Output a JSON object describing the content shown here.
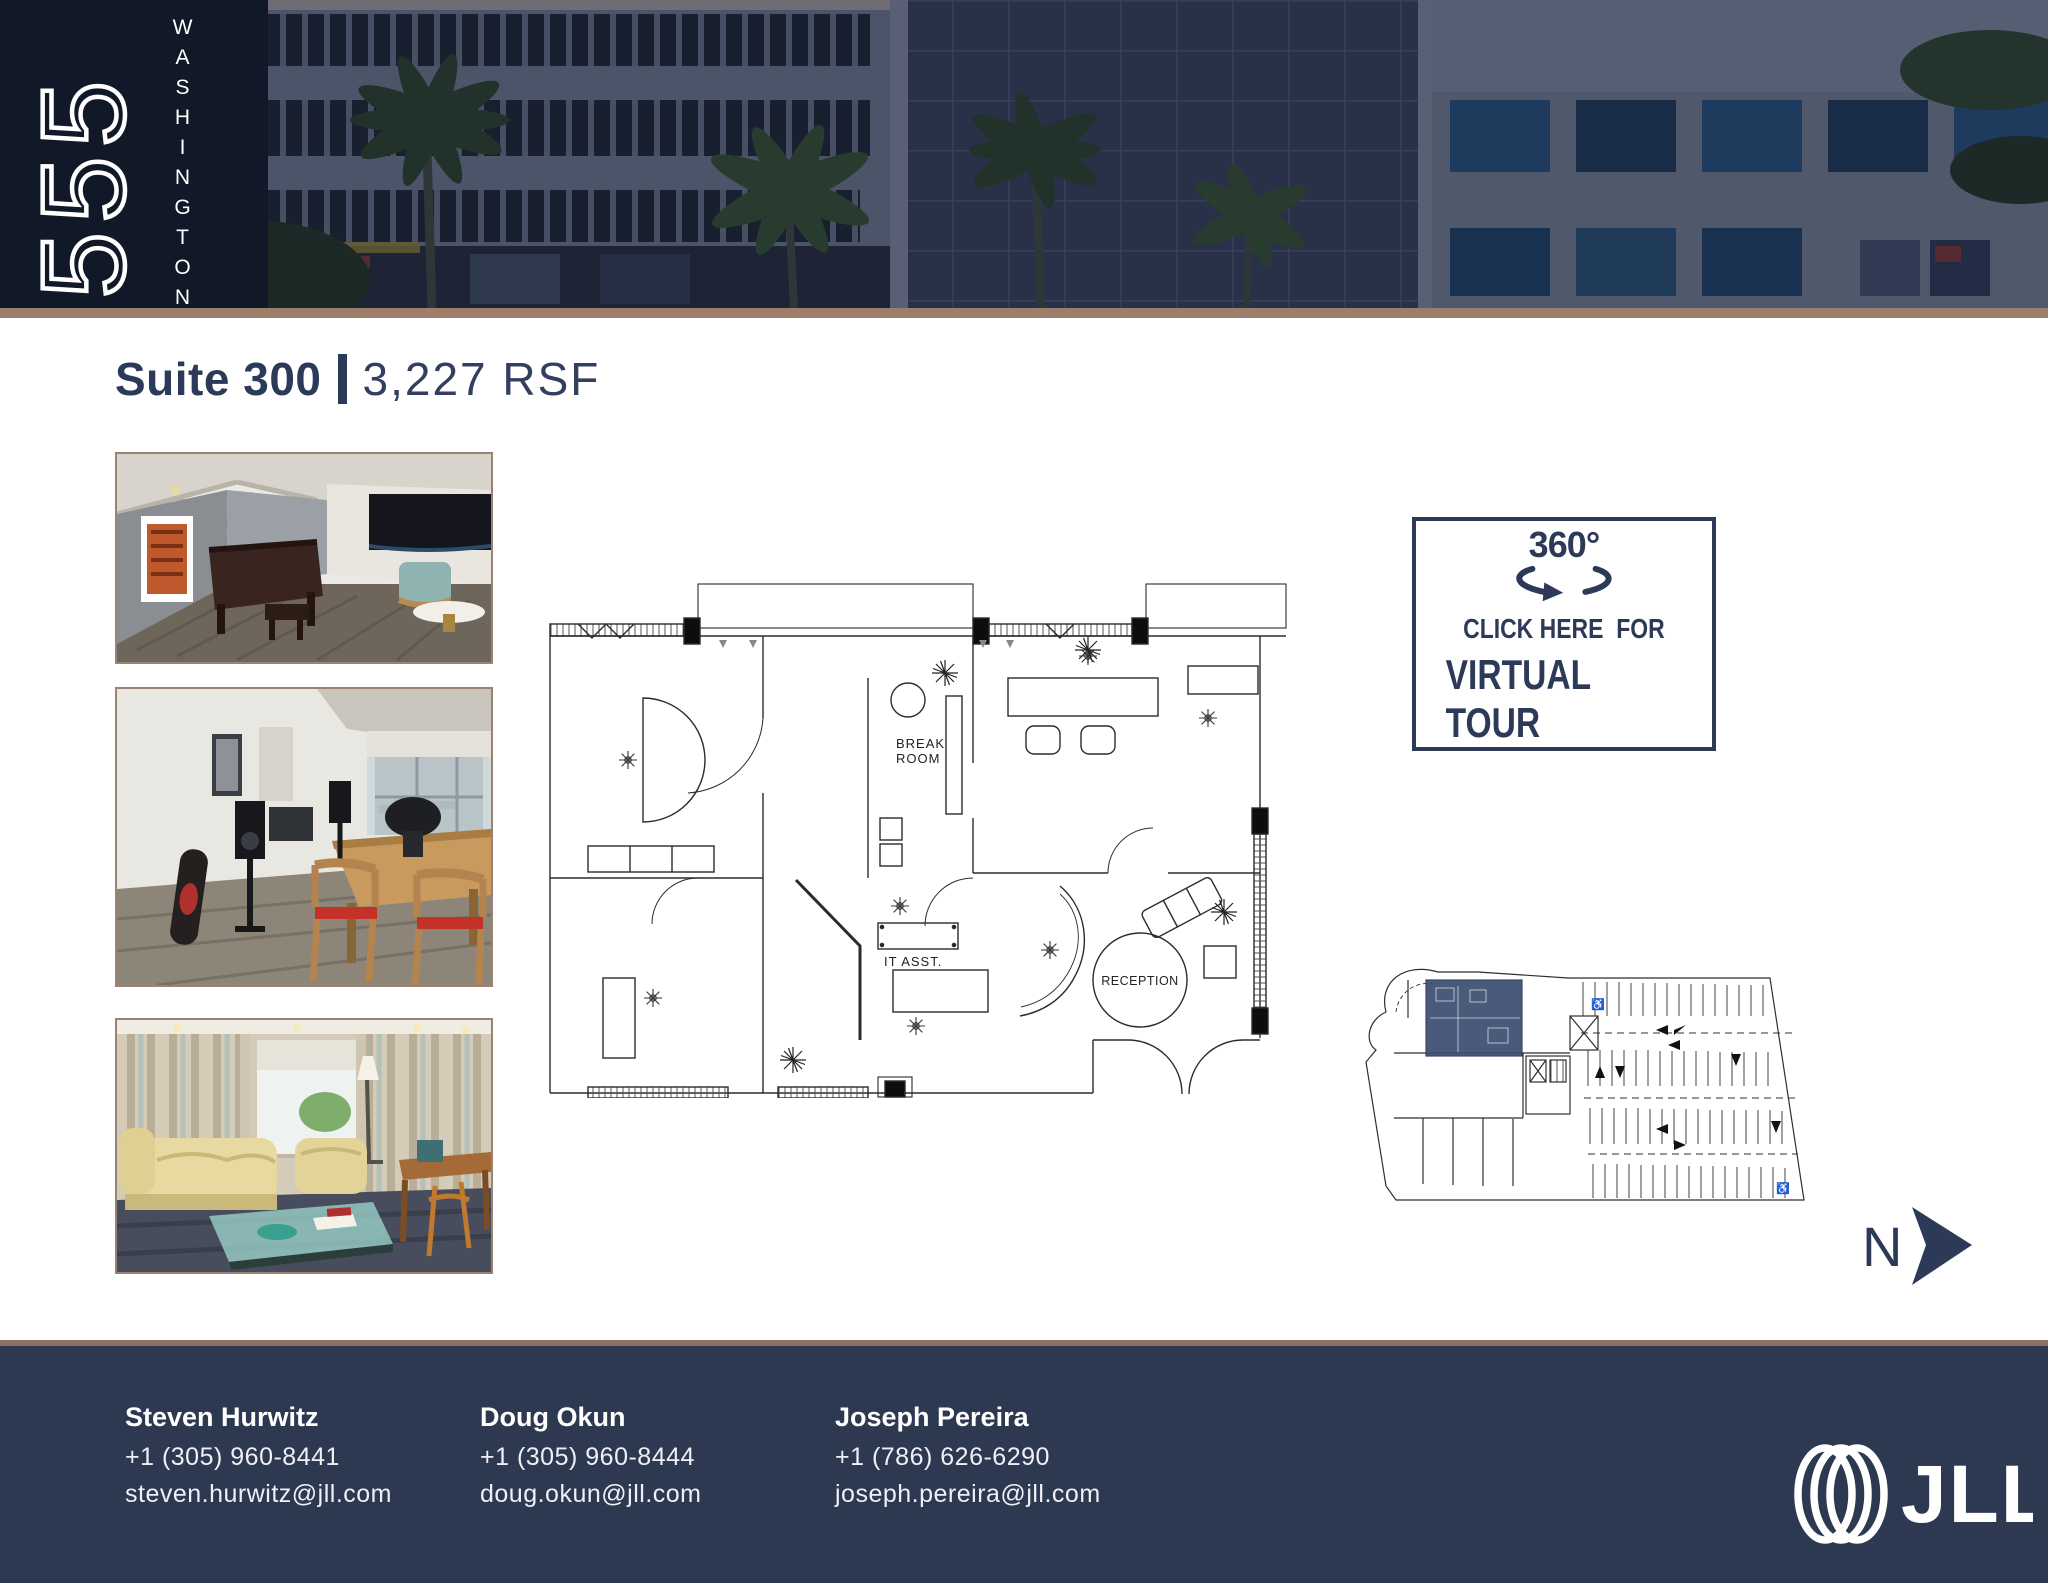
{
  "brand": {
    "number": "555",
    "name": "WASHINGTON"
  },
  "title": {
    "suite": "Suite 300",
    "rsf": "3,227 RSF"
  },
  "virtual_tour": {
    "degrees": "360°",
    "line1": "CLICK HERE  FOR",
    "line2": "VIRTUAL TOUR"
  },
  "floor_plan_labels": {
    "break_line1": "BREAK",
    "break_line2": "ROOM",
    "it_assist": "IT ASST.",
    "reception": "RECEPTION"
  },
  "key_plan": {
    "north": "N",
    "accessible": "♿"
  },
  "footer": {
    "contacts": [
      {
        "name": "Steven Hurwitz",
        "phone": "+1 (305) 960-8441",
        "email": "steven.hurwitz@jll.com"
      },
      {
        "name": "Doug Okun",
        "phone": "+1 (305) 960-8444",
        "email": "doug.okun@jll.com"
      },
      {
        "name": "Joseph Pereira",
        "phone": "+1 (786) 626-6290",
        "email": "joseph.pereira@jll.com"
      }
    ],
    "jll_wordmark": "JLL"
  },
  "colors": {
    "navy": "#2b3a58",
    "logo_background": "#111828",
    "tan_bar": "#9c7e6b",
    "footer_background": "#2d3851",
    "suite_highlight": "#3d4e71"
  }
}
